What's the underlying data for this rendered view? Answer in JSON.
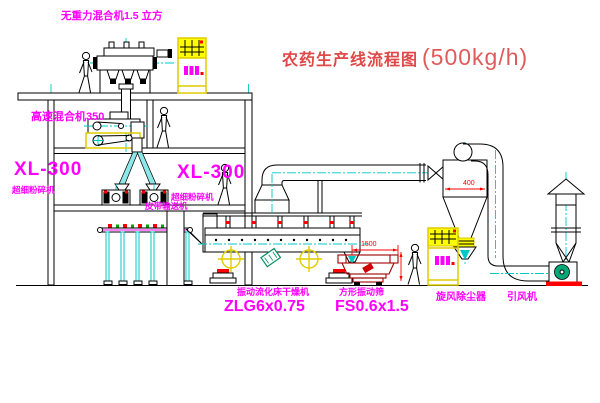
{
  "title": {
    "text": "农药生产线流程图",
    "capacity": "(500kg/h)"
  },
  "labels": {
    "gravity_mixer": "无重力混合机1.5 立方",
    "high_speed_mixer": "高速混合机350",
    "mill_left_model": "XL-300",
    "mill_left_name": "超细粉碎机",
    "mill_right_model": "XL-300",
    "mill_right_name": "超细粉碎机",
    "belt_conveyor": "皮带输送机",
    "dryer_name": "振动流化床干燥机",
    "dryer_model": "ZLG6x0.75",
    "screen_name": "方形振动筛",
    "screen_model": "FS0.6x1.5",
    "cyclone": "旋风除尘器",
    "fan": "引风机"
  },
  "dimensions": {
    "screen_length": "1500",
    "cyclone_diameter": "400"
  },
  "colors": {
    "line_black": "#000000",
    "centerline_cyan": "#00c8c8",
    "label_magenta": "#ff00ff",
    "title_red": "#e04848",
    "dimension_red": "#ff0000",
    "cabinet_yellow": "#ffff00",
    "motor_green": "#00a878",
    "screen_dark_red": "#a00000"
  }
}
